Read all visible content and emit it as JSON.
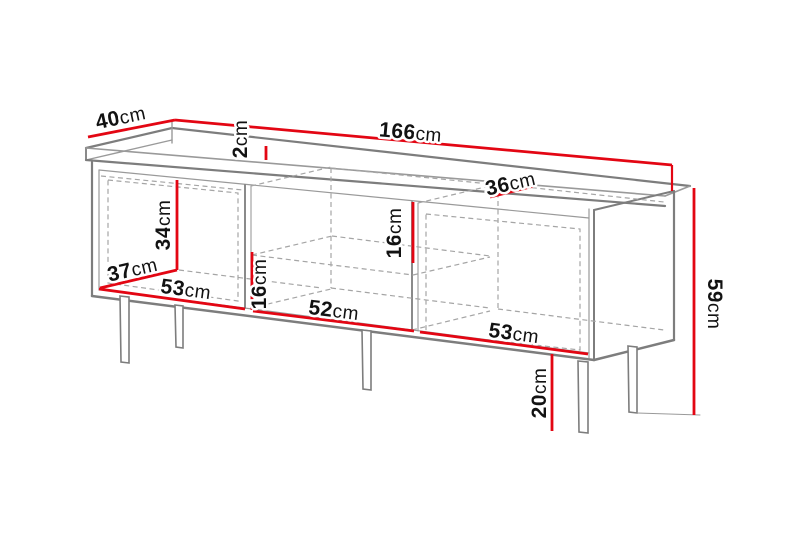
{
  "diagram": {
    "title": "TV cabinet dimension diagram",
    "unit": "cm",
    "colors": {
      "dimension_line": "#e30613",
      "structure_line": "#7d7d7d",
      "dashed_line": "#a5a5a5",
      "label_text": "#121212",
      "background": "#ffffff"
    },
    "dimensions": [
      {
        "id": "top-depth",
        "num": "40",
        "unit": "cm",
        "value": 40
      },
      {
        "id": "top-width",
        "num": "166",
        "unit": "cm",
        "value": 166
      },
      {
        "id": "top-panel-thickness",
        "num": "2",
        "unit": "cm",
        "value": 2
      },
      {
        "id": "top-inner-depth",
        "num": "36",
        "unit": "cm",
        "value": 36
      },
      {
        "id": "left-compartment-height",
        "num": "34",
        "unit": "cm",
        "value": 34
      },
      {
        "id": "left-compartment-depth",
        "num": "37",
        "unit": "cm",
        "value": 37
      },
      {
        "id": "left-compartment-width",
        "num": "53",
        "unit": "cm",
        "value": 53
      },
      {
        "id": "middle-lower-niche-height",
        "num": "16",
        "unit": "cm",
        "value": 16
      },
      {
        "id": "middle-compartment-width",
        "num": "52",
        "unit": "cm",
        "value": 52
      },
      {
        "id": "middle-upper-niche-height",
        "num": "16",
        "unit": "cm",
        "value": 16
      },
      {
        "id": "right-compartment-width",
        "num": "53",
        "unit": "cm",
        "value": 53
      },
      {
        "id": "total-height",
        "num": "59",
        "unit": "cm",
        "value": 59
      },
      {
        "id": "leg-height",
        "num": "20",
        "unit": "cm",
        "value": 20
      }
    ]
  }
}
